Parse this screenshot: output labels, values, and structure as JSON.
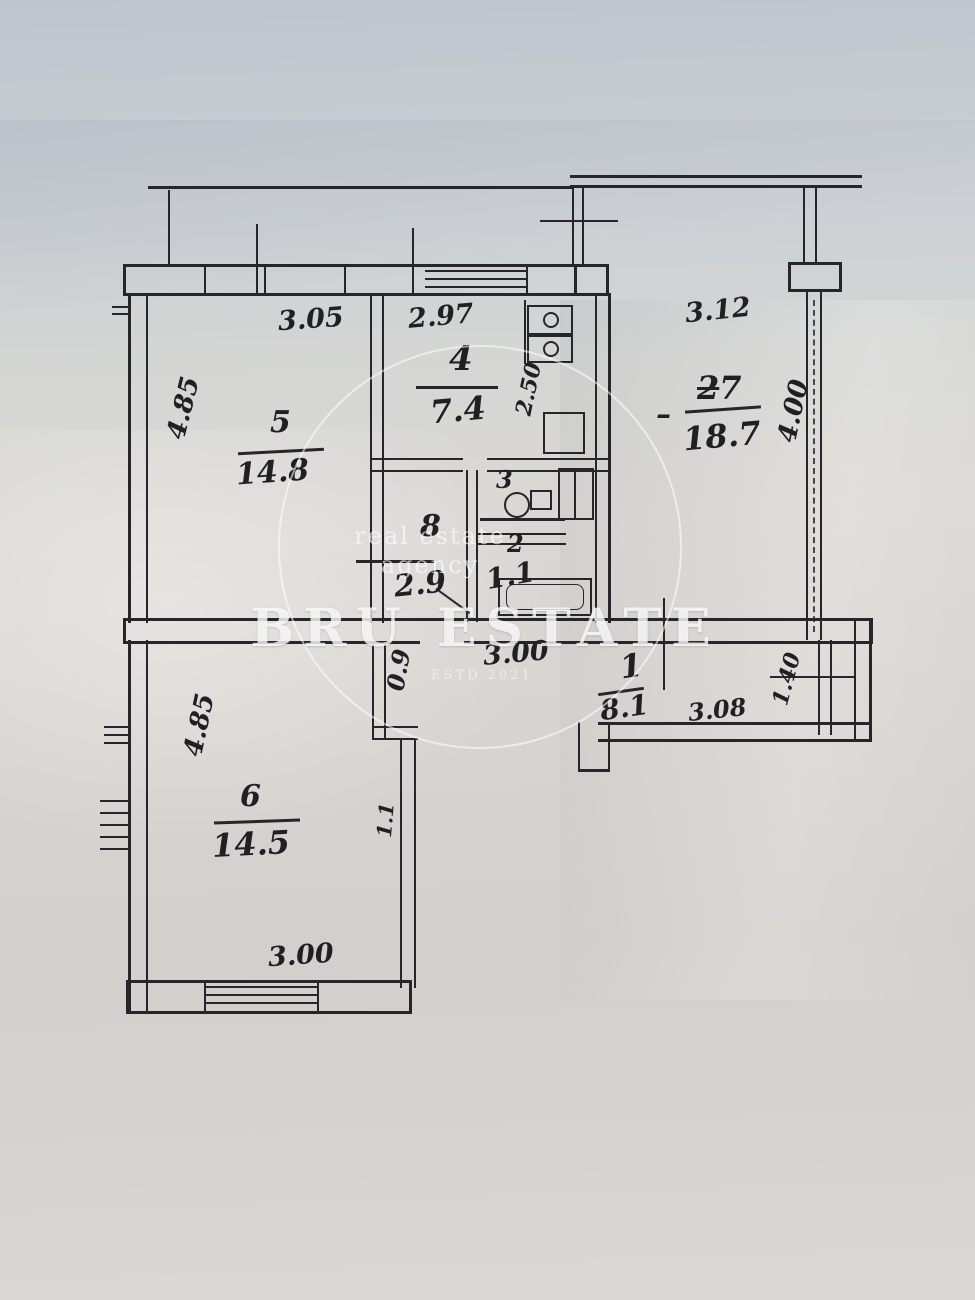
{
  "watermark": {
    "line1": "real estate",
    "line2": "agency",
    "brand": "BRU ESTATE",
    "estd": "ESTD 2021"
  },
  "rooms": {
    "r5": {
      "number": "5",
      "area": "14.8"
    },
    "r4": {
      "number": "4",
      "area": "7.4"
    },
    "r7": {
      "leader": "–",
      "number_old": "2",
      "number": "7",
      "area": "18.7"
    },
    "r8": {
      "number": "8",
      "area": "2.9"
    },
    "r3": {
      "number": "3"
    },
    "r2": {
      "number": "2",
      "area": "1.1"
    },
    "r1": {
      "number": "1",
      "area": "8.1"
    },
    "r6": {
      "number": "6",
      "area": "14.5"
    }
  },
  "dims": {
    "top_room5": "3.05",
    "top_room4": "2.97",
    "top_room7": "3.12",
    "left_room5": "4.85",
    "kitchen_side": "2.50",
    "right_room7": "4.00",
    "hall_width": "3.00",
    "hall_door": "0.9",
    "hall_right": "3.08",
    "hall_right_depth": "1.40",
    "left_room6": "4.85",
    "room6_side": "1.1",
    "bottom_room6": "3.00"
  }
}
